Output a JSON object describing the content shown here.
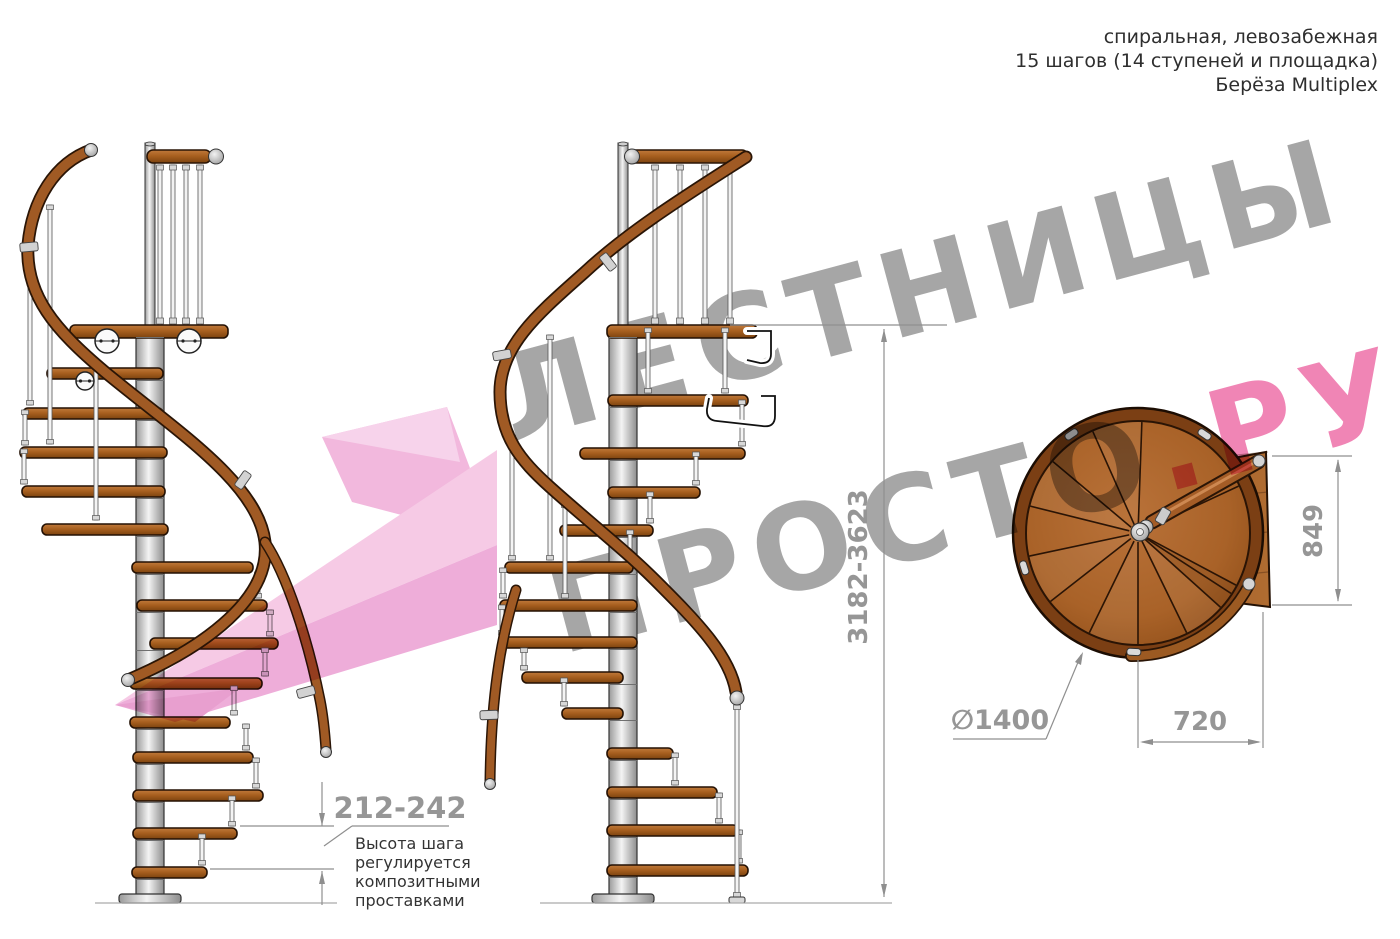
{
  "header": {
    "line1": "спиральная, левозабежная",
    "line2": "15 шагов (14 ступеней и площадка)",
    "line3": "Берёза Multiplex"
  },
  "watermark": {
    "line1": "ЛЕСТНИЦЫ",
    "line2_gray": "ПРОСТО",
    "line2_pink": ".РУ",
    "gray_color": "#a6a6a6",
    "pink_color": "#f085b5",
    "arrow_color": "#f1b2da"
  },
  "dimensions": {
    "total_height": "3182-3623",
    "step_height": "212-242",
    "platform_depth": "849",
    "platform_width": "720",
    "diameter": "∅1400",
    "step_note": [
      "Высота шага",
      "регулируется",
      "композитными",
      "проставками"
    ]
  },
  "materials": {
    "wood": "#a96228",
    "wood_dark": "#7b3f14",
    "metal": "#d9d9d9",
    "dim_gray": "#8f8f8f"
  }
}
